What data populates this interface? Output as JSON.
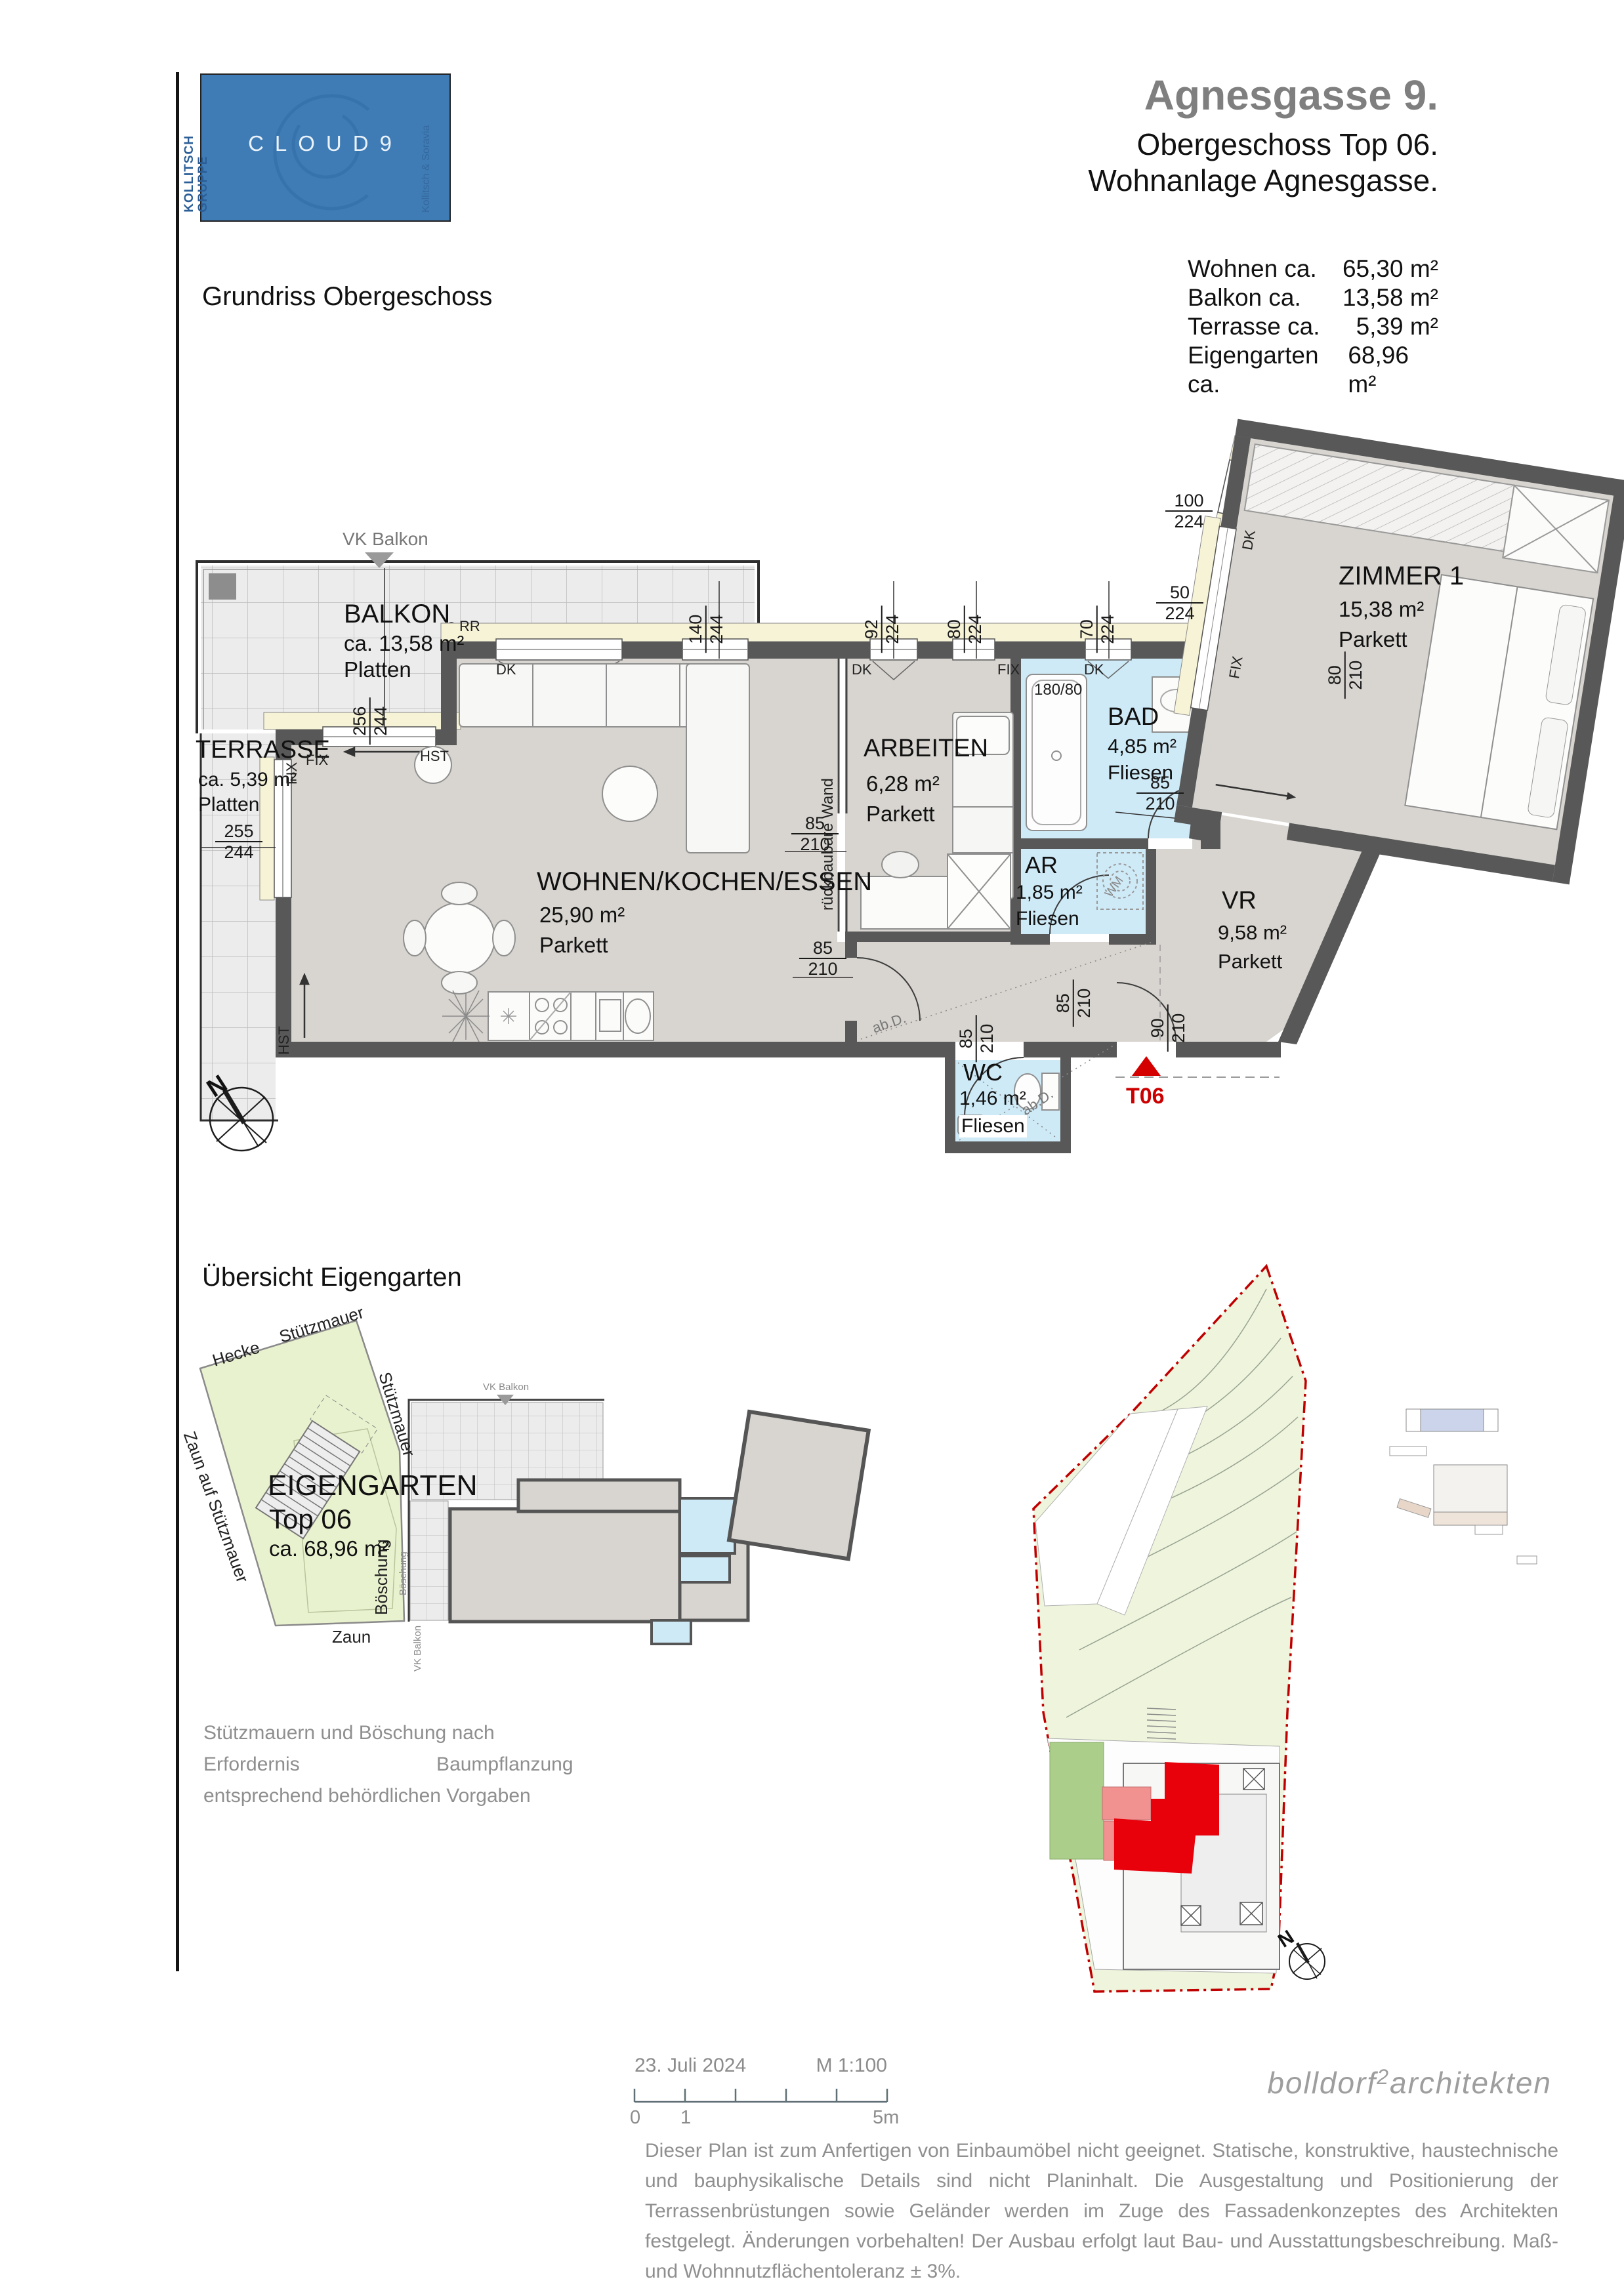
{
  "logo": {
    "brand": "CLOUD9",
    "left1": "KOLLITSCH",
    "left2": "GRUPPE",
    "right": "Kollitsch & Soravia"
  },
  "header": {
    "title": "Agnesgasse 9.",
    "subtitle1": "Obergeschoss Top 06.",
    "subtitle2": "Wohnanlage Agnesgasse."
  },
  "plan_heading": "Grundriss Obergeschoss",
  "area_table": {
    "rows": [
      {
        "label": "Wohnen ca.",
        "value": "65,30 m²"
      },
      {
        "label": "Balkon ca.",
        "value": "13,58 m²"
      },
      {
        "label": "Terrasse ca.",
        "value": "5,39 m²"
      },
      {
        "label": "Eigengarten ca.",
        "value": "68,96 m²"
      }
    ]
  },
  "rooms": {
    "balkon": {
      "name": "BALKON",
      "area": "ca. 13,58 m²",
      "floor": "Platten"
    },
    "terrasse": {
      "name": "TERRASSE",
      "area": "ca. 5,39 m²",
      "floor": "Platten"
    },
    "wohnen": {
      "name": "WOHNEN/KOCHEN/ESSEN",
      "area": "25,90 m²",
      "floor": "Parkett"
    },
    "arbeiten": {
      "name": "ARBEITEN",
      "area": "6,28 m²",
      "floor": "Parkett"
    },
    "bad": {
      "name": "BAD",
      "area": "4,85 m²",
      "floor": "Fliesen"
    },
    "ar": {
      "name": "AR",
      "area": "1,85 m²",
      "floor": "Fliesen"
    },
    "vr": {
      "name": "VR",
      "area": "9,58 m²",
      "floor": "Parkett"
    },
    "wc": {
      "name": "WC",
      "area": "1,46 m²",
      "floor": "Fliesen"
    },
    "zimmer1": {
      "name": "ZIMMER 1",
      "area": "15,38 m²",
      "floor": "Parkett"
    }
  },
  "plan_labels": {
    "vk_balkon": "VK Balkon",
    "rr": "RR",
    "dk": "DK",
    "fix": "FIX",
    "hst": "HST",
    "tub": "180/80",
    "wand": "rückbaubare Wand",
    "abd": "ab.D.",
    "wm": "WM",
    "unit": "T06",
    "north": "N"
  },
  "dims": {
    "d140": {
      "a": "140",
      "b": "244"
    },
    "d92": {
      "a": "92",
      "b": "224"
    },
    "d80": {
      "a": "80",
      "b": "224"
    },
    "d70": {
      "a": "70",
      "b": "224"
    },
    "d50": {
      "a": "50",
      "b": "224"
    },
    "d100": {
      "a": "100",
      "b": "224"
    },
    "d256": {
      "a": "256",
      "b": "244"
    },
    "d255": {
      "a": "255",
      "b": "244"
    },
    "d85": {
      "a": "85",
      "b": "210"
    },
    "d90": {
      "a": "90",
      "b": "210"
    },
    "d80b": {
      "a": "80",
      "b": "210"
    }
  },
  "garden": {
    "heading": "Übersicht Eigengarten",
    "name": "EIGENGARTEN",
    "top": "Top 06",
    "area": "ca. 68,96 m²",
    "labels": {
      "hecke": "Hecke",
      "stuetz1": "Stützmauer",
      "stuetz2": "Stützmauer",
      "zaun_stuetz": "Zaun auf Stützmauer",
      "zaun": "Zaun",
      "boeschung": "Böschung",
      "boeschung2": "Böschung",
      "vk": "VK Balkon"
    },
    "note_l1": "Stützmauern und Böschung nach",
    "note_l2": "Erfordernis Baumpflanzung",
    "note_l3": "entsprechend behördlichen Vorgaben"
  },
  "footer": {
    "date": "23. Juli 2024",
    "scale": "M 1:100",
    "tick0": "0",
    "tick1": "1",
    "tick5": "5m",
    "architect_a": "bolldorf",
    "architect_sup": "2",
    "architect_b": "architekten",
    "disclaimer": "Dieser Plan ist zum Anfertigen von Einbaumöbel nicht geeignet. Statische, konstruktive, haustechnische und bauphysikalische Details sind nicht Planinhalt. Die Ausgestaltung und Positionierung der Terrassenbrüstungen sowie Geländer werden im Zuge des Fassadenkonzeptes des Architekten festgelegt. Änderungen vorbehalten! Der Ausbau erfolgt laut Bau- und Ausstattungsbeschreibung. Maß- und Wohnnutzflächentoleranz ± 3%."
  }
}
